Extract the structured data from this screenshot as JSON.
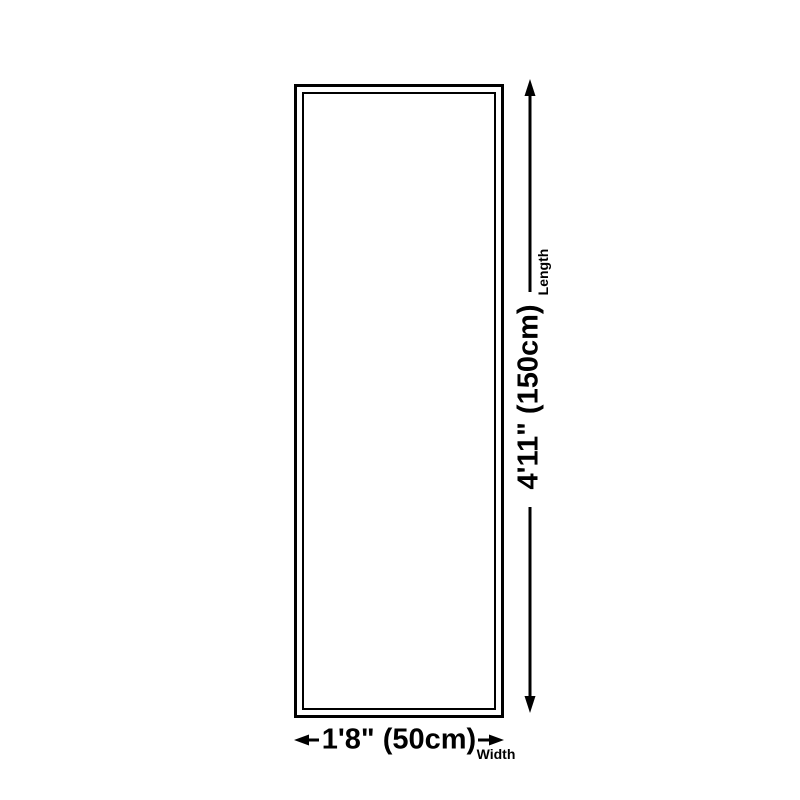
{
  "diagram": {
    "type": "product-dimension-diagram",
    "length_value": "4'11\" (150cm)",
    "length_label": "Length",
    "width_value": "1'8\" (50cm)",
    "width_label": "Width",
    "colors": {
      "line": "#000000",
      "background": "#ffffff"
    }
  }
}
